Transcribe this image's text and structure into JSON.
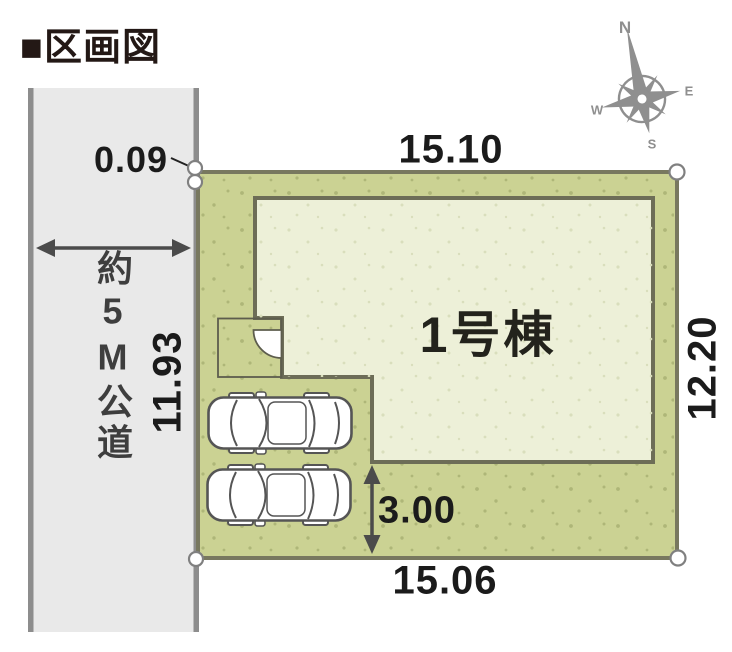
{
  "title": "■区画図",
  "road": {
    "label": "約5M公道"
  },
  "building": {
    "label": "1号棟"
  },
  "dimensions": {
    "top": "15.10",
    "bottom": "15.06",
    "left": "11.93",
    "right": "12.20",
    "corner_offset": "0.09",
    "parking_depth": "3.00"
  },
  "compass": {
    "north": "N",
    "east": "E",
    "south": "S",
    "west": "W"
  },
  "colors": {
    "plot_fill": "#cbd293",
    "plot_dots": "#aeb678",
    "plot_border": "#78785f",
    "building_fill": "#edf0d8",
    "building_dots": "#d9debc",
    "building_border": "#6d6d57",
    "road_fill": "#e9e9e9",
    "road_border": "#8d8d8d",
    "arrow": "#4b4b4b",
    "text": "#1b1b1b",
    "title_text": "#231815",
    "compass": "#8f8f8f"
  }
}
